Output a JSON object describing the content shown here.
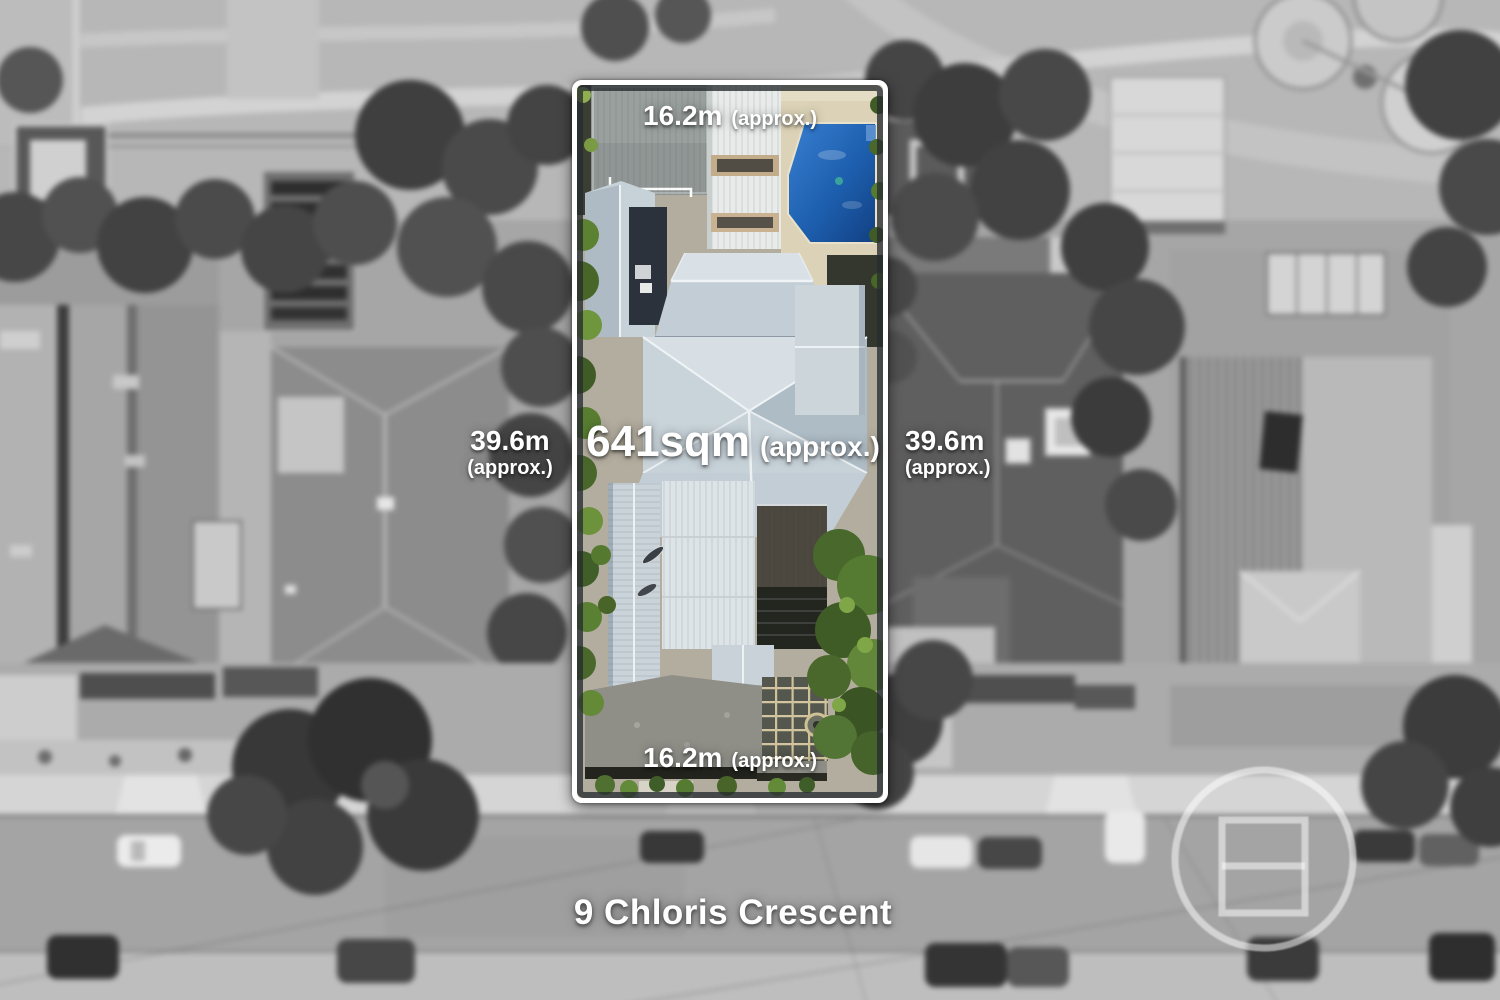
{
  "image": {
    "type": "real-estate aerial land-dimension photo",
    "address": "9 Chloris Crescent"
  },
  "boundary": {
    "top": {
      "value": "16.2m",
      "qualifier": "(approx.)"
    },
    "bottom": {
      "value": "16.2m",
      "qualifier": "(approx.)"
    },
    "left": {
      "value": "39.6m",
      "qualifier": "(approx.)"
    },
    "right": {
      "value": "39.6m",
      "qualifier": "(approx.)"
    }
  },
  "area": {
    "value": "641sqm",
    "qualifier": "(approx.)"
  },
  "branding": {
    "logo": "circle-square-watermark"
  },
  "colors": {
    "boundary_stroke": "#ffffff",
    "label_text": "#ffffff",
    "pool": "#1d5fae",
    "roof_metal": "#c6d1d8",
    "trees": "#557a31"
  }
}
